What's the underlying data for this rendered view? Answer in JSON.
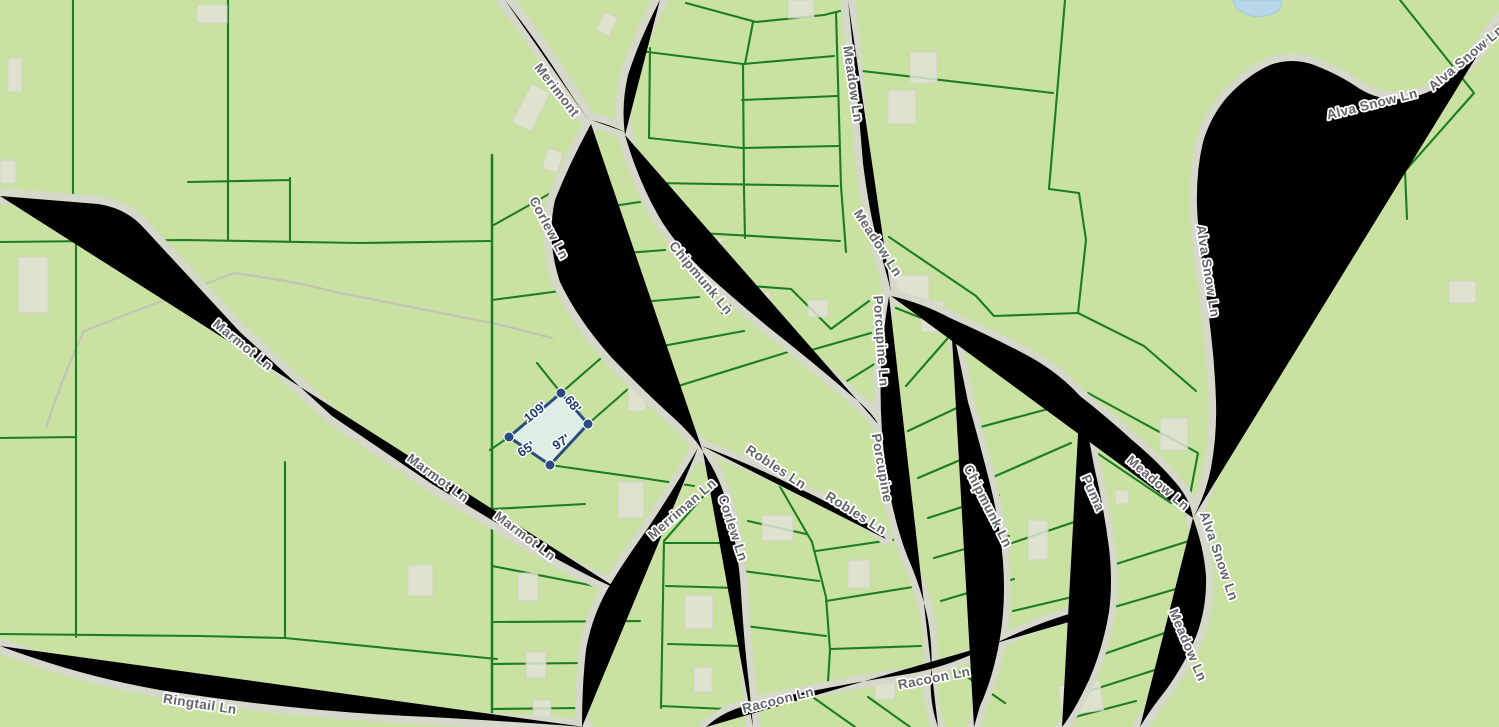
{
  "map": {
    "description": "GIS parcel map with selected lot and edge dimensions",
    "colors": {
      "background": "#c9e1a1",
      "parcel_line": "#1b7e20",
      "road_fill": "#ffffff",
      "road_casing": "#d6d8cb",
      "road_label": "#63666a",
      "building": "#e2e3d8",
      "water": "#b9d7ea",
      "trail": "#c2c4b6",
      "selection_stroke": "#2b4c80",
      "selection_fill": "#e1efe9",
      "dimension_text": "#1c3c72"
    }
  },
  "road_labels": [
    {
      "text": "Merimont"
    },
    {
      "text": "Corlew Ln"
    },
    {
      "text": "Chipmunk Ln"
    },
    {
      "text": "Meadow Ln"
    },
    {
      "text": "Meadow Ln"
    },
    {
      "text": "Porcupine Ln"
    },
    {
      "text": "Porcupine"
    },
    {
      "text": "Robles Ln"
    },
    {
      "text": "Robles Ln"
    },
    {
      "text": "Marmot Ln"
    },
    {
      "text": "Marmot Ln"
    },
    {
      "text": "Marmot Ln"
    },
    {
      "text": "Merriman Ln"
    },
    {
      "text": "Corlew Ln"
    },
    {
      "text": "Racoon Ln"
    },
    {
      "text": "Racoon Ln"
    },
    {
      "text": "Ringtail Ln"
    },
    {
      "text": "Puma"
    },
    {
      "text": "Meadow Ln"
    },
    {
      "text": "Alva Snow Ln"
    },
    {
      "text": "Meadow Ln"
    },
    {
      "text": "Alva Snow Ln"
    },
    {
      "text": "Alva Snow Ln"
    },
    {
      "text": "Alva Snow Ln"
    },
    {
      "text": "Chipmunk Ln"
    }
  ],
  "selected_parcel": {
    "status": "selected",
    "dimensions": [
      {
        "side": "northwest",
        "label": "109'"
      },
      {
        "side": "northeast",
        "label": "68'"
      },
      {
        "side": "southwest",
        "label": "65'"
      },
      {
        "side": "southeast",
        "label": "97'"
      }
    ]
  }
}
